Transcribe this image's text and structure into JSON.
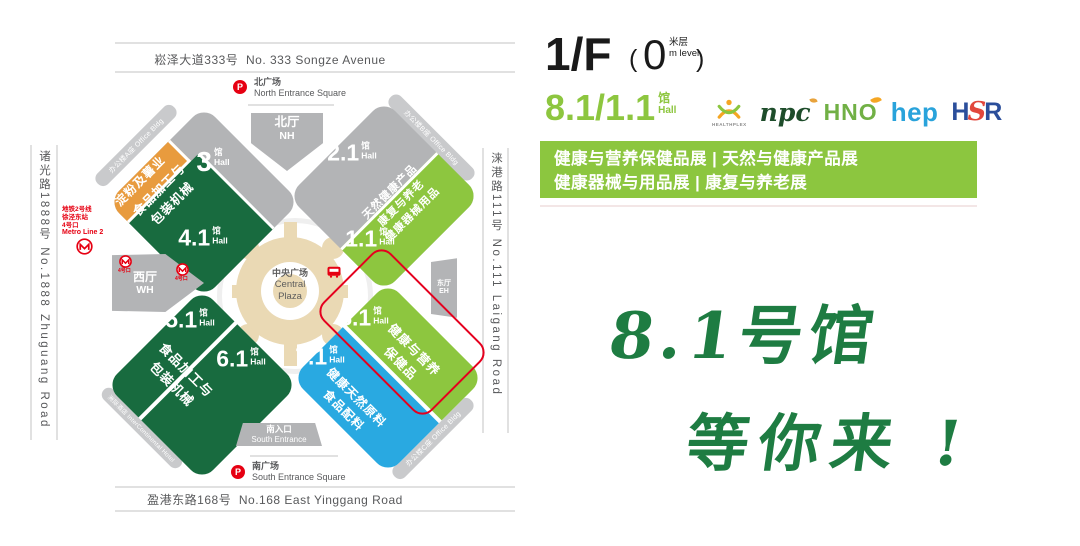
{
  "colors": {
    "light_green": "#8DC63F",
    "dark_green": "#186B3F",
    "blue": "#29A9E1",
    "orange": "#E89B3E",
    "gray": "#b3b4b6",
    "red": "#E60012",
    "tan": "#EAD9B4",
    "slogan_green": "#1E7C42"
  },
  "map": {
    "road_north_cn": "崧泽大道333号",
    "road_north_en": "No. 333 Songze Avenue",
    "road_west": "诸光路1888号  No.1888 Zhuguang Road",
    "road_east": "涞港路111号  No.111 Laigang Road",
    "road_south_cn": "盈港东路168号",
    "road_south_en": "No.168 East Yinggang Road",
    "parking_label": "P",
    "square_north_cn": "北广场",
    "square_north_en": "North Entrance Square",
    "square_south_cn": "南广场",
    "square_south_en": "South Entrance Square",
    "hall_north_cn": "北厅",
    "hall_north_en": "NH",
    "hall_west_cn": "西厅",
    "hall_west_en": "WH",
    "hall_east_cn": "东厅",
    "hall_east_en": "EH",
    "entrance_south_cn": "南入口",
    "entrance_south_en": "South Entrance",
    "plaza_cn": "中央广场",
    "plaza_en1": "Central",
    "plaza_en2": "Plaza",
    "unit_cn": "馆",
    "unit_en": "Hall",
    "halls": {
      "h3": "3",
      "h21": "2.1",
      "h41": "4.1",
      "h11": "1.1",
      "h51": "5.1",
      "h61": "6.1",
      "h71": "7.1",
      "h81": "8.1"
    },
    "strip_starch": "淀粉及薯业",
    "nw_industry1": "食品加工与",
    "nw_industry2": "包装机械",
    "ne_industry1": "天然健康产品",
    "ne_industry2": "康复与养老",
    "ne_industry3": "健康器械用品",
    "sw_industry1": "食品加工与",
    "sw_industry2": "包装机械",
    "se81_industry1": "健康与营养",
    "se81_industry2": "保健品",
    "se71_industry1": "健康天然原料",
    "se71_industry2": "食品配料",
    "bldg_a": "办公楼A座 Office Bldg",
    "bldg_b": "办公楼B座 Office Bldg",
    "bldg_c": "办公楼C座 Office Bldg",
    "hotel": "洲际酒店 InterContinental Hotel",
    "metro_l1": "地铁2号线",
    "metro_l2": "徐泾东站",
    "metro_l3": "4号口",
    "metro_l4": "Metro Line 2",
    "metro_exit": "4号口"
  },
  "panel": {
    "floor_big": "1/F",
    "paren_open": "(",
    "floor_zero": "0",
    "floor_unit_cn": "米层",
    "floor_unit_en": "m level",
    "paren_close": ")",
    "hall_no": "8.1/1.1",
    "hall_unit_cn": "馆",
    "hall_unit_en": "Hall",
    "logo_healthplex": "HEALTHPLEX",
    "logo_npc": "npc",
    "logo_hno": "HNO",
    "logo_hep": "hep",
    "logo_hsr_h": "H",
    "logo_hsr_s": "S",
    "logo_hsr_r": "R",
    "banner_line1": "健康与营养保健品展 | 天然与健康产品展",
    "banner_line2": "健康器械与用品展 | 康复与养老展",
    "slogan_line1": "8.1号馆",
    "slogan_line2": "等你来 !"
  }
}
